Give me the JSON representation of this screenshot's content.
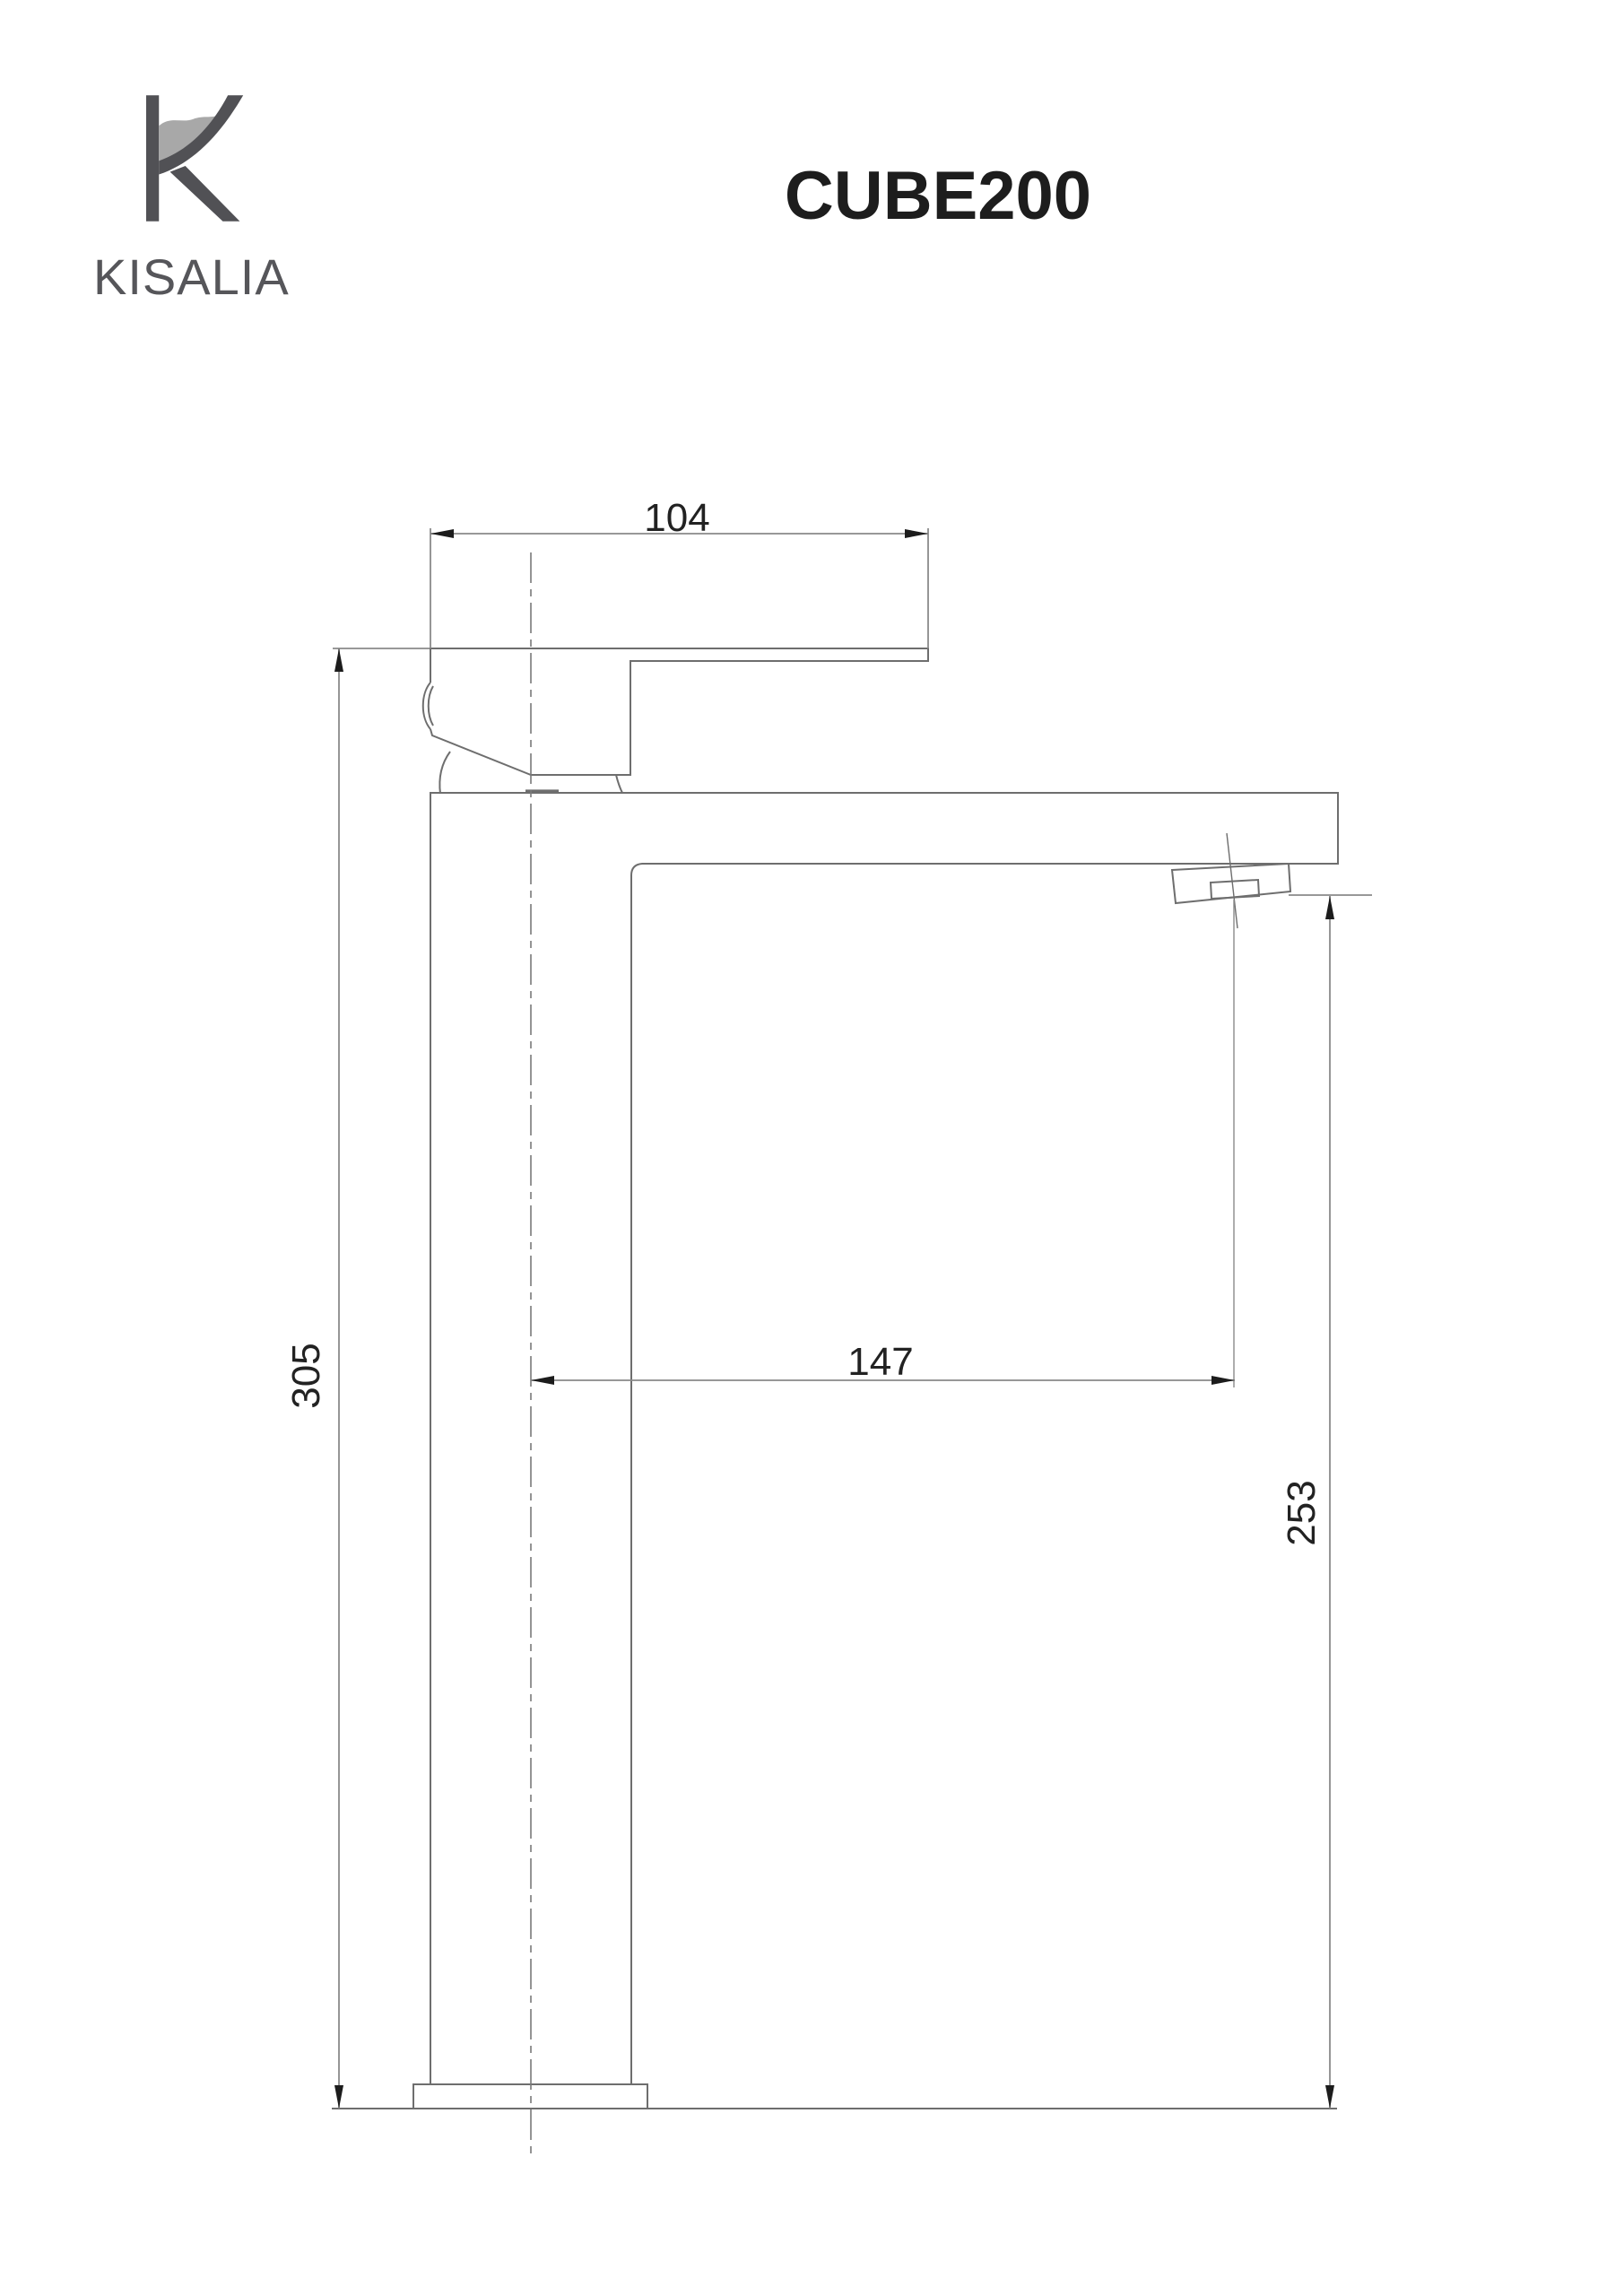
{
  "header": {
    "brand": "KISALIA",
    "product_title": "CUBE200"
  },
  "drawing": {
    "dim_handle_length": "104",
    "dim_total_height": "305",
    "dim_spout_reach": "147",
    "dim_spout_height": "253"
  },
  "icons": {
    "logo": "kisalia-k-wave-logo"
  },
  "colors": {
    "structure_line": "#6e6e6e",
    "dimension_line": "#8a8a8a",
    "dimension_text": "#222222",
    "title_text": "#1d1d1d",
    "brand_gray": "#56565a",
    "wave_gray": "#a8a8a8"
  }
}
